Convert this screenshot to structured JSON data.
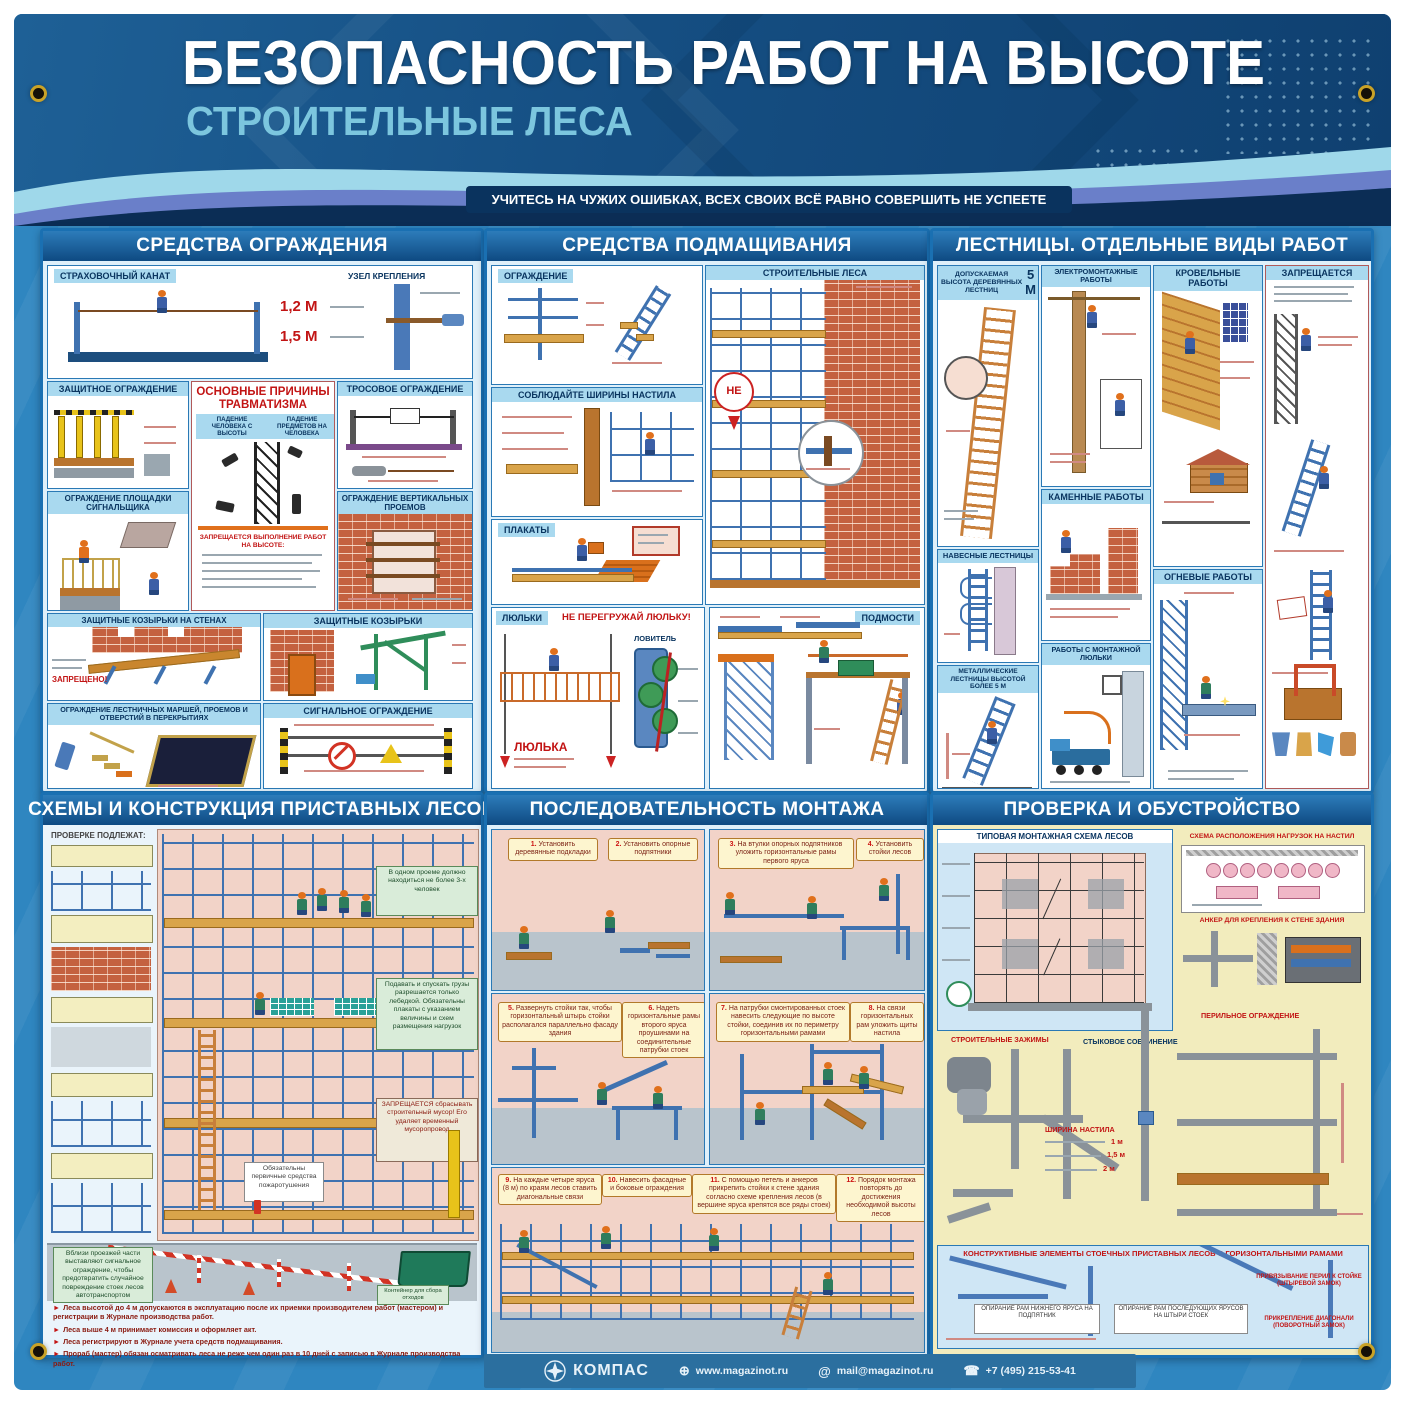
{
  "header": {
    "title": "БЕЗОПАСНОСТЬ РАБОТ НА ВЫСОТЕ",
    "subtitle": "СТРОИТЕЛЬНЫЕ ЛЕСА",
    "motto": "УЧИТЕСЬ НА ЧУЖИХ ОШИБКАХ, ВСЕХ СВОИХ ВСЁ РАВНО СОВЕРШИТЬ НЕ УСПЕЕТЕ"
  },
  "p1": {
    "title": "СРЕДСТВА ОГРАЖДЕНИЯ",
    "rope": "СТРАХОВОЧНЫЙ КАНАТ",
    "node": "УЗЕЛ КРЕПЛЕНИЯ",
    "h12": "1,2 М",
    "h15": "1,5 М",
    "protect": "ЗАЩИТНОЕ ОГРАЖДЕНИЕ",
    "causes": "ОСНОВНЫЕ ПРИЧИНЫ ТРАВМАТИЗМА",
    "cause1": "ПАДЕНИЕ ЧЕЛОВЕКА С ВЫСОТЫ",
    "cause2": "ПАДЕНИЕ ПРЕДМЕТОВ НА ЧЕЛОВЕКА",
    "forbid": "ЗАПРЕЩАЕТСЯ ВЫПОЛНЕНИЕ РАБОТ НА ВЫСОТЕ:",
    "cable": "ТРОСОВОЕ ОГРАЖДЕНИЕ",
    "signaler": "ОГРАЖДЕНИЕ ПЛОЩАДКИ СИГНАЛЬЩИКА",
    "vert": "ОГРАЖДЕНИЕ ВЕРТИКАЛЬНЫХ ПРОЕМОВ",
    "canopy_wall": "ЗАЩИТНЫЕ КОЗЫРЬКИ НА СТЕНАХ",
    "banned": "ЗАПРЕЩЕНО!",
    "canopy": "ЗАЩИТНЫЕ КОЗЫРЬКИ",
    "stairs": "ОГРАЖДЕНИЕ ЛЕСТНИЧНЫХ МАРШЕЙ, ПРОЕМОВ И ОТВЕРСТИЙ В ПЕРЕКРЫТИЯХ",
    "signal": "СИГНАЛЬНОЕ ОГРАЖДЕНИЕ"
  },
  "p2": {
    "title": "СРЕДСТВА ПОДМАЩИВАНИЯ",
    "fence": "ОГРАЖДЕНИЕ",
    "width": "СОБЛЮДАЙТЕ ШИРИНЫ НАСТИЛА",
    "posters": "ПЛАКАТЫ",
    "scaff": "СТРОИТЕЛЬНЫЕ ЛЕСА",
    "no": "НЕ",
    "cradles": "ЛЮЛЬКИ",
    "overload": "НЕ ПЕРЕГРУЖАЙ ЛЮЛЬКУ!",
    "catcher": "ЛОВИТЕЛЬ",
    "cradle_red": "ЛЮЛЬКА",
    "trestles": "ПОДМОСТИ"
  },
  "p3": {
    "title": "ЛЕСТНИЦЫ. ОТДЕЛЬНЫЕ ВИДЫ РАБОТ",
    "wood": "ДОПУСКАЕМАЯ ВЫСОТА ДЕРЕВЯННЫХ ЛЕСТНИЦ",
    "wood_h": "5 М",
    "electro": "ЭЛЕКТРОМОНТАЖНЫЕ РАБОТЫ",
    "roof": "КРОВЕЛЬНЫЕ РАБОТЫ",
    "ban": "ЗАПРЕЩАЕТСЯ",
    "hang": "НАВЕСНЫЕ ЛЕСТНИЦЫ",
    "stone": "КАМЕННЫЕ РАБОТЫ",
    "metal": "МЕТАЛЛИЧЕСКИЕ ЛЕСТНИЦЫ ВЫСОТОЙ БОЛЕЕ 5 М",
    "lift": "РАБОТЫ С МОНТАЖНОЙ ЛЮЛЬКИ",
    "fire": "ОГНЕВЫЕ РАБОТЫ"
  },
  "p4": {
    "title": "СХЕМЫ И КОНСТРУКЦИЯ ПРИСТАВНЫХ ЛЕСОВ",
    "check": "ПРОВЕРКЕ ПОДЛЕЖАТ:",
    "note1": "В одном проеме должно находиться не более 3-х человек",
    "note2": "Подавать и спускать грузы разрешается только лебедкой. Обязательны плакаты с указанием величины и схем размещения нагрузок",
    "note3": "ЗАПРЕЩАЕТСЯ сбрасывать строительный мусор! Его удаляет временный мусоропровод",
    "note4": "Обязательны первичные средства пожаротушения",
    "note5": "Вблизи проезжей части выставляют сигнальное ограждение, чтобы предотвратить случайное повреждение стоек лесов автотранспортом",
    "note6": "Контейнер для сбора отходов",
    "rules": [
      "Леса высотой до 4 м допускаются в эксплуатацию после их приемки производителем работ (мастером) и регистрации в Журнале производства работ.",
      "Леса выше 4 м принимает комиссия и оформляет акт.",
      "Леса регистрируют в Журнале учета средств подмащивания.",
      "Прораб (мастер) обязан осматривать леса не реже чем один раз в 10 дней с записью в Журнале производства работ."
    ]
  },
  "p5": {
    "title": "ПОСЛЕДОВАТЕЛЬНОСТЬ МОНТАЖА",
    "steps": [
      {
        "n": "1.",
        "t": "Установить деревянные подкладки"
      },
      {
        "n": "2.",
        "t": "Установить опорные подпятники"
      },
      {
        "n": "3.",
        "t": "На втулки опорных подпятников уложить горизонтальные рамы первого яруса"
      },
      {
        "n": "4.",
        "t": "Установить стойки лесов"
      },
      {
        "n": "5.",
        "t": "Развернуть стойки так, чтобы горизонтальный штырь стойки располагался параллельно фасаду здания"
      },
      {
        "n": "6.",
        "t": "Надеть горизонтальные рамы второго яруса проушинами на соединительные патрубки стоек"
      },
      {
        "n": "7.",
        "t": "На патрубки смонтированных стоек навесить следующие по высоте стойки, соединив их по периметру горизонтальными рамами"
      },
      {
        "n": "8.",
        "t": "На связи горизонтальных рам уложить щиты настила"
      },
      {
        "n": "9.",
        "t": "На каждые четыре яруса (8 м) по краям лесов ставить диагональные связи"
      },
      {
        "n": "10.",
        "t": "Навесить фасадные и боковые ограждения"
      },
      {
        "n": "11.",
        "t": "С помощью петель и анкеров прикрепить стойки к стене здания согласно схеме крепления лесов (в вершине яруса крепятся все ряды стоек)"
      },
      {
        "n": "12.",
        "t": "Порядок монтажа повторять до достижения необходимой высоты лесов"
      }
    ]
  },
  "p6": {
    "title": "ПРОВЕРКА И ОБУСТРОЙСТВО",
    "scheme": "ТИПОВАЯ МОНТАЖНАЯ СХЕМА ЛЕСОВ",
    "loads": "СХЕМА РАСПОЛОЖЕНИЯ НАГРУЗОК НА НАСТИЛ",
    "anchor": "АНКЕР ДЛЯ КРЕПЛЕНИЯ К СТЕНЕ ЗДАНИЯ",
    "joint": "СТЫКОВОЕ СОЕДИНЕНИЕ",
    "clamps": "СТРОИТЕЛЬНЫЕ ЗАЖИМЫ",
    "deck": "ШИРИНА НАСТИЛА",
    "deck_v1": "1 м",
    "deck_v2": "1,5 м",
    "deck_v3": "2 м",
    "rail": "ПЕРИЛЬНОЕ ОГРАЖДЕНИЕ",
    "elements": "КОНСТРУКТИВНЫЕ ЭЛЕМЕНТЫ СТОЕЧНЫХ ПРИСТАВНЫХ ЛЕСОВ С ГОРИЗОНТАЛЬНЫМИ РАМАМИ",
    "el1": "ОПИРАНИЕ РАМ НИЖНЕГО ЯРУСА НА ПОДПЯТНИК",
    "el2": "ОПИРАНИЕ РАМ ПОСЛЕДУЮЩИХ ЯРУСОВ НА ШТЫРИ СТОЕК",
    "el3": "ПРИВЯЗЫВАНИЕ ПЕРИЛ К СТОЙКЕ (ШТЫРЕВОЙ ЗАМОК)",
    "el4": "ПРИКРЕПЛЕНИЕ ДИАГОНАЛИ (ПОВОРОТНЫЙ ЗАМОК)"
  },
  "footer": {
    "brand": "КОМПАС",
    "site": "www.magazinot.ru",
    "email": "mail@magazinot.ru",
    "phone": "+7 (495) 215-53-41"
  }
}
